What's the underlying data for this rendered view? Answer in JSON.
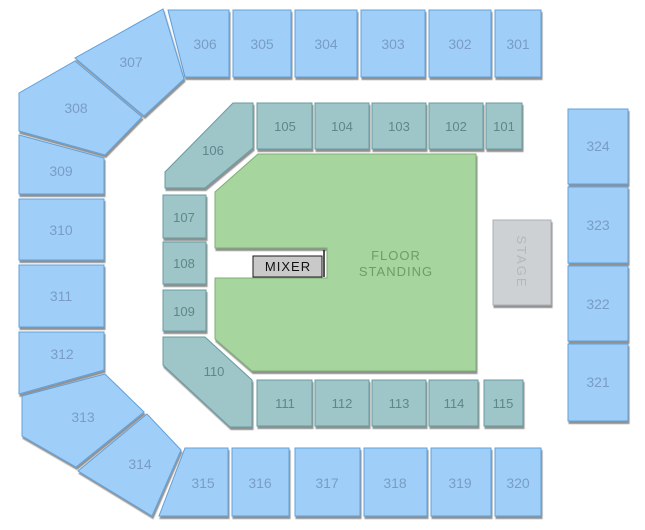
{
  "colors": {
    "background": "#ffffff",
    "outer-fill": "#9fcff8",
    "outer-stroke": "#61a0da",
    "outer-label": "#7a9cc4",
    "inner-fill": "#9ec5c8",
    "inner-stroke": "#689b9f",
    "inner-label": "#5f868b",
    "floor-fill": "#a6d59d",
    "floor-stroke": "#7fae77",
    "floor-label": "#6f9d69",
    "stage-fill": "#cdd1d4",
    "stage-stroke": "#abb0b4",
    "stage-label": "#b2b8bc",
    "mixer-fill": "#c9c9c9",
    "mixer-stroke": "#1a1a1a",
    "mixer-label": "#111111"
  },
  "sections": {
    "301": {
      "label": "301"
    },
    "302": {
      "label": "302"
    },
    "303": {
      "label": "303"
    },
    "304": {
      "label": "304"
    },
    "305": {
      "label": "305"
    },
    "306": {
      "label": "306"
    },
    "307": {
      "label": "307"
    },
    "308": {
      "label": "308"
    },
    "309": {
      "label": "309"
    },
    "310": {
      "label": "310"
    },
    "311": {
      "label": "311"
    },
    "312": {
      "label": "312"
    },
    "313": {
      "label": "313"
    },
    "314": {
      "label": "314"
    },
    "315": {
      "label": "315"
    },
    "316": {
      "label": "316"
    },
    "317": {
      "label": "317"
    },
    "318": {
      "label": "318"
    },
    "319": {
      "label": "319"
    },
    "320": {
      "label": "320"
    },
    "321": {
      "label": "321"
    },
    "322": {
      "label": "322"
    },
    "323": {
      "label": "323"
    },
    "324": {
      "label": "324"
    },
    "101": {
      "label": "101"
    },
    "102": {
      "label": "102"
    },
    "103": {
      "label": "103"
    },
    "104": {
      "label": "104"
    },
    "105": {
      "label": "105"
    },
    "106": {
      "label": "106"
    },
    "107": {
      "label": "107"
    },
    "108": {
      "label": "108"
    },
    "109": {
      "label": "109"
    },
    "110": {
      "label": "110"
    },
    "111": {
      "label": "111"
    },
    "112": {
      "label": "112"
    },
    "113": {
      "label": "113"
    },
    "114": {
      "label": "114"
    },
    "115": {
      "label": "115"
    }
  },
  "floor": {
    "line1": "FLOOR",
    "line2": "STANDING"
  },
  "stage": {
    "label": "STAGE"
  },
  "mixer": {
    "label": "MIXER"
  }
}
